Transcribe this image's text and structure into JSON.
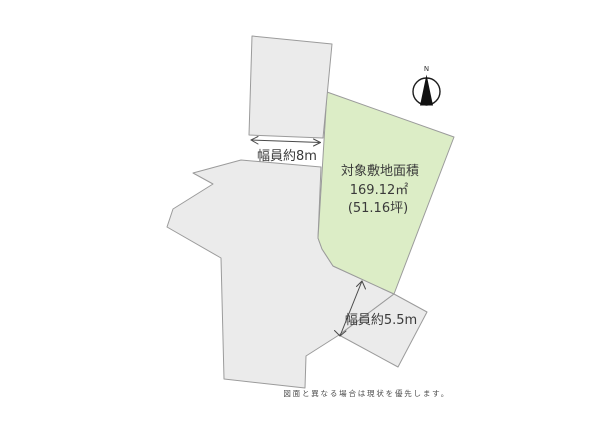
{
  "diagram": {
    "background": "#ffffff",
    "road_fill": "#ebebeb",
    "road_stroke": "#9b9b9b",
    "labels": {
      "top_road_width": "幅員約8m",
      "side_road_width": "幅員約5.5m"
    }
  },
  "plot": {
    "fill": "#dcedc6",
    "title": "対象敷地面積",
    "area_sqm": "169.12㎡",
    "area_tsubo": "(51.16坪)"
  },
  "compass": {
    "north_label": "N"
  },
  "footer": {
    "disclaimer": "図面と異なる場合は現状を優先します。"
  }
}
